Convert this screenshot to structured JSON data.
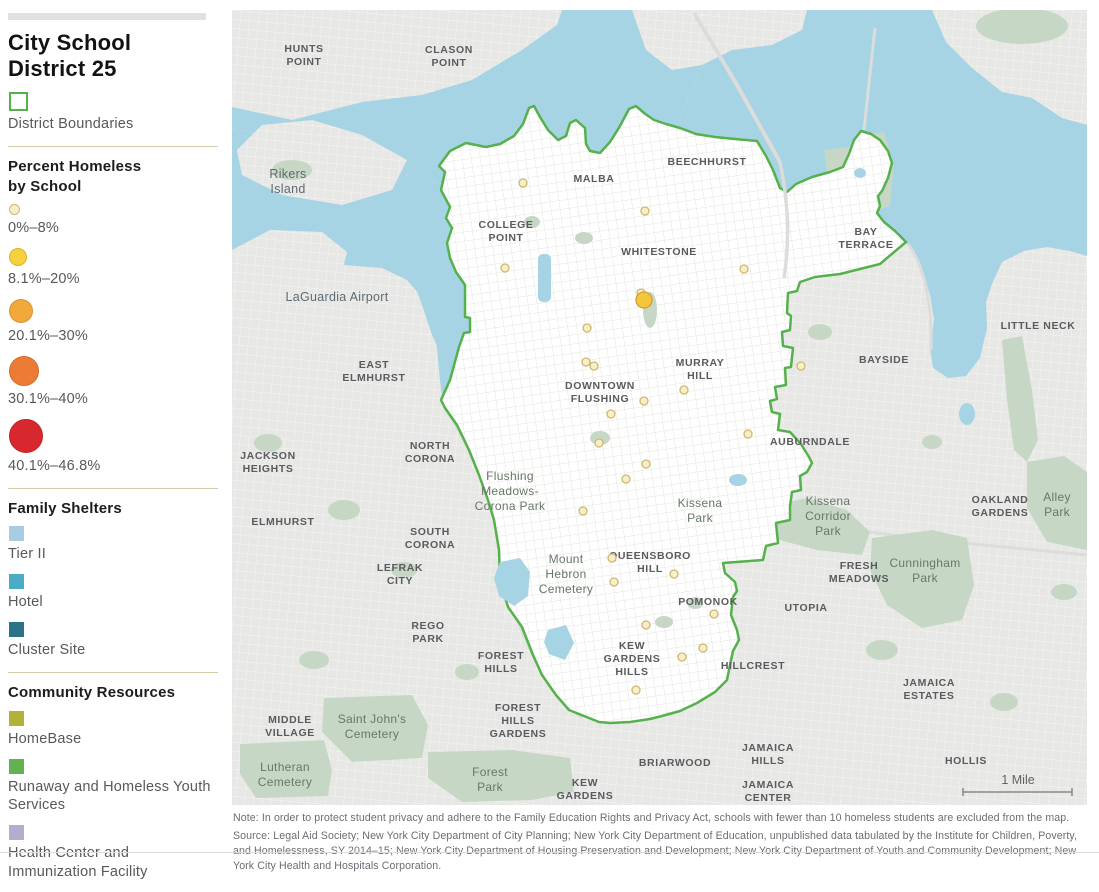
{
  "legend": {
    "title_line1": "City School",
    "title_line2": "District 25",
    "district_boundaries": {
      "label": "District Boundaries",
      "swatch_fill": "#ffffff",
      "swatch_border": "#55b14b"
    },
    "percent_section": {
      "heading_line1": "Percent Homeless",
      "heading_line2": "by School",
      "classes": [
        {
          "label": "0%–8%",
          "fill": "#f8eec9",
          "stroke": "#cdb86d",
          "diameter": 9
        },
        {
          "label": "8.1%–20%",
          "fill": "#f7d13d",
          "stroke": "#e0ae33",
          "diameter": 16
        },
        {
          "label": "20.1%–30%",
          "fill": "#f0a93a",
          "stroke": "#d99430",
          "diameter": 22
        },
        {
          "label": "30.1%–40%",
          "fill": "#ec7b35",
          "stroke": "#d66c2c",
          "diameter": 28
        },
        {
          "label": "40.1%–46.8%",
          "fill": "#d7282f",
          "stroke": "#c02027",
          "diameter": 32
        }
      ]
    },
    "family_shelters": {
      "heading": "Family Shelters",
      "items": [
        {
          "label": "Tier II",
          "color": "#a9cde0"
        },
        {
          "label": "Hotel",
          "color": "#4aabc7"
        },
        {
          "label": "Cluster Site",
          "color": "#2c7286"
        }
      ]
    },
    "community_resources": {
      "heading": "Community Resources",
      "items": [
        {
          "label": "HomeBase",
          "color": "#b2b236"
        },
        {
          "label": "Runaway and Homeless Youth Services",
          "color": "#64b150"
        },
        {
          "label": "Health Center and Immunization Facility",
          "color": "#b7abce"
        }
      ]
    }
  },
  "map": {
    "colors": {
      "water": "#a7d4e4",
      "land": "#e7e8e5",
      "land_line": "#f4f4f1",
      "district_fill": "#ffffff",
      "district_line": "#e4e4e0",
      "park": "#c6d8c5",
      "boundary": "#55b14b",
      "road": "#dcdcda",
      "channel": "#c3d3da"
    },
    "scale_bar": {
      "label": "1 Mile"
    },
    "school_classes": {
      "c1": {
        "fill": "#f8eec9",
        "stroke": "#cdb86d",
        "r": 4
      },
      "c3": {
        "fill": "#f2c83b",
        "stroke": "#d89b33",
        "r": 8
      }
    },
    "schools": [
      {
        "x": 291,
        "y": 173,
        "c": "c1"
      },
      {
        "x": 413,
        "y": 201,
        "c": "c1"
      },
      {
        "x": 273,
        "y": 258,
        "c": "c1"
      },
      {
        "x": 512,
        "y": 259,
        "c": "c1"
      },
      {
        "x": 409,
        "y": 283,
        "c": "c1"
      },
      {
        "x": 412,
        "y": 290,
        "c": "c3"
      },
      {
        "x": 355,
        "y": 318,
        "c": "c1"
      },
      {
        "x": 354,
        "y": 352,
        "c": "c1"
      },
      {
        "x": 362,
        "y": 356,
        "c": "c1"
      },
      {
        "x": 569,
        "y": 356,
        "c": "c1"
      },
      {
        "x": 452,
        "y": 380,
        "c": "c1"
      },
      {
        "x": 412,
        "y": 391,
        "c": "c1"
      },
      {
        "x": 379,
        "y": 404,
        "c": "c1"
      },
      {
        "x": 367,
        "y": 433,
        "c": "c1"
      },
      {
        "x": 516,
        "y": 424,
        "c": "c1"
      },
      {
        "x": 414,
        "y": 454,
        "c": "c1"
      },
      {
        "x": 394,
        "y": 469,
        "c": "c1"
      },
      {
        "x": 351,
        "y": 501,
        "c": "c1"
      },
      {
        "x": 380,
        "y": 548,
        "c": "c1"
      },
      {
        "x": 382,
        "y": 572,
        "c": "c1"
      },
      {
        "x": 442,
        "y": 564,
        "c": "c1"
      },
      {
        "x": 482,
        "y": 604,
        "c": "c1"
      },
      {
        "x": 414,
        "y": 615,
        "c": "c1"
      },
      {
        "x": 471,
        "y": 638,
        "c": "c1"
      },
      {
        "x": 450,
        "y": 647,
        "c": "c1"
      },
      {
        "x": 404,
        "y": 680,
        "c": "c1"
      }
    ],
    "labels": [
      {
        "x": 72,
        "y": 42,
        "lines": [
          "HUNTS",
          "POINT"
        ],
        "style": "area"
      },
      {
        "x": 217,
        "y": 43,
        "lines": [
          "CLASON",
          "POINT"
        ],
        "style": "area"
      },
      {
        "x": 56,
        "y": 168,
        "lines": [
          "Rikers",
          "Island"
        ],
        "style": "place"
      },
      {
        "x": 105,
        "y": 291,
        "lines": [
          "LaGuardia Airport"
        ],
        "style": "place"
      },
      {
        "x": 362,
        "y": 172,
        "lines": [
          "MALBA"
        ],
        "style": "area"
      },
      {
        "x": 475,
        "y": 155,
        "lines": [
          "BEECHHURST"
        ],
        "style": "area"
      },
      {
        "x": 274,
        "y": 218,
        "lines": [
          "COLLEGE",
          "POINT"
        ],
        "style": "area"
      },
      {
        "x": 427,
        "y": 245,
        "lines": [
          "WHITESTONE"
        ],
        "style": "area"
      },
      {
        "x": 634,
        "y": 225,
        "lines": [
          "BAY",
          "TERRACE"
        ],
        "style": "area"
      },
      {
        "x": 806,
        "y": 319,
        "lines": [
          "LITTLE NECK"
        ],
        "style": "area"
      },
      {
        "x": 652,
        "y": 353,
        "lines": [
          "BAYSIDE"
        ],
        "style": "area"
      },
      {
        "x": 468,
        "y": 356,
        "lines": [
          "MURRAY",
          "HILL"
        ],
        "style": "area"
      },
      {
        "x": 368,
        "y": 379,
        "lines": [
          "DOWNTOWN",
          "FLUSHING"
        ],
        "style": "area"
      },
      {
        "x": 578,
        "y": 435,
        "lines": [
          "AUBURNDALE"
        ],
        "style": "area"
      },
      {
        "x": 142,
        "y": 358,
        "lines": [
          "EAST",
          "ELMHURST"
        ],
        "style": "area"
      },
      {
        "x": 36,
        "y": 449,
        "lines": [
          "JACKSON",
          "HEIGHTS"
        ],
        "style": "area"
      },
      {
        "x": 198,
        "y": 439,
        "lines": [
          "NORTH",
          "CORONA"
        ],
        "style": "area"
      },
      {
        "x": 51,
        "y": 515,
        "lines": [
          "ELMHURST"
        ],
        "style": "area"
      },
      {
        "x": 198,
        "y": 525,
        "lines": [
          "SOUTH",
          "CORONA"
        ],
        "style": "area"
      },
      {
        "x": 278,
        "y": 470,
        "lines": [
          "Flushing",
          "Meadows-",
          "Corona Park"
        ],
        "style": "park"
      },
      {
        "x": 468,
        "y": 497,
        "lines": [
          "Kissena",
          "Park"
        ],
        "style": "park"
      },
      {
        "x": 596,
        "y": 495,
        "lines": [
          "Kissena",
          "Corridor",
          "Park"
        ],
        "style": "park"
      },
      {
        "x": 768,
        "y": 493,
        "lines": [
          "OAKLAND",
          "GARDENS"
        ],
        "style": "area"
      },
      {
        "x": 825,
        "y": 491,
        "lines": [
          "Alley",
          "Park"
        ],
        "style": "park"
      },
      {
        "x": 168,
        "y": 561,
        "lines": [
          "LEFRAK",
          "CITY"
        ],
        "style": "area"
      },
      {
        "x": 334,
        "y": 553,
        "lines": [
          "Mount",
          "Hebron",
          "Cemetery"
        ],
        "style": "park"
      },
      {
        "x": 418,
        "y": 549,
        "lines": [
          "QUEENSBORO",
          "HILL"
        ],
        "style": "area"
      },
      {
        "x": 476,
        "y": 595,
        "lines": [
          "POMONOK"
        ],
        "style": "area"
      },
      {
        "x": 627,
        "y": 559,
        "lines": [
          "FRESH",
          "MEADOWS"
        ],
        "style": "area"
      },
      {
        "x": 693,
        "y": 557,
        "lines": [
          "Cunningham",
          "Park"
        ],
        "style": "park"
      },
      {
        "x": 574,
        "y": 601,
        "lines": [
          "UTOPIA"
        ],
        "style": "area"
      },
      {
        "x": 196,
        "y": 619,
        "lines": [
          "REGO",
          "PARK"
        ],
        "style": "area"
      },
      {
        "x": 269,
        "y": 649,
        "lines": [
          "FOREST",
          "HILLS"
        ],
        "style": "area"
      },
      {
        "x": 400,
        "y": 639,
        "lines": [
          "KEW",
          "GARDENS",
          "HILLS"
        ],
        "style": "area"
      },
      {
        "x": 521,
        "y": 659,
        "lines": [
          "HILLCREST"
        ],
        "style": "area"
      },
      {
        "x": 697,
        "y": 676,
        "lines": [
          "JAMAICA",
          "ESTATES"
        ],
        "style": "area"
      },
      {
        "x": 58,
        "y": 713,
        "lines": [
          "MIDDLE",
          "VILLAGE"
        ],
        "style": "area"
      },
      {
        "x": 140,
        "y": 713,
        "lines": [
          "Saint John's",
          "Cemetery"
        ],
        "style": "park"
      },
      {
        "x": 286,
        "y": 701,
        "lines": [
          "FOREST",
          "HILLS",
          "GARDENS"
        ],
        "style": "area"
      },
      {
        "x": 53,
        "y": 761,
        "lines": [
          "Lutheran",
          "Cemetery"
        ],
        "style": "park"
      },
      {
        "x": 258,
        "y": 766,
        "lines": [
          "Forest",
          "Park"
        ],
        "style": "park"
      },
      {
        "x": 353,
        "y": 776,
        "lines": [
          "KEW",
          "GARDENS"
        ],
        "style": "area"
      },
      {
        "x": 443,
        "y": 756,
        "lines": [
          "BRIARWOOD"
        ],
        "style": "area"
      },
      {
        "x": 536,
        "y": 741,
        "lines": [
          "JAMAICA",
          "HILLS"
        ],
        "style": "area"
      },
      {
        "x": 536,
        "y": 778,
        "lines": [
          "JAMAICA",
          "CENTER"
        ],
        "style": "area"
      },
      {
        "x": 734,
        "y": 754,
        "lines": [
          "HOLLIS"
        ],
        "style": "area"
      }
    ]
  },
  "footer": {
    "note": "Note: In order to protect student privacy and adhere to the Family Education Rights and Privacy Act, schools with fewer than 10 homeless students are excluded from the map.",
    "source": "Source: Legal Aid Society; New York City Department of City Planning; New York City Department of Education, unpublished data tabulated by the Institute for Children, Poverty, and Homelessness, SY 2014–15; New York City Department of Housing Preservation and Development; New York City Department of Youth and Community Development; New York City Health and Hospitals Corporation."
  }
}
